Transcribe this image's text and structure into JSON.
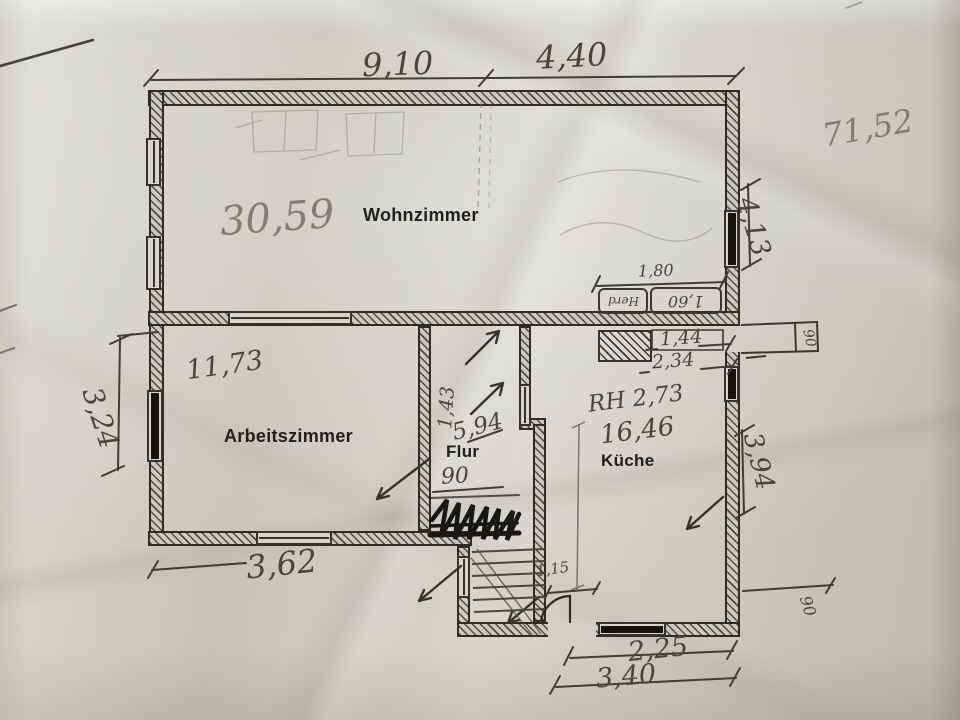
{
  "rooms": {
    "wohnzimmer": {
      "label": "Wohnzimmer",
      "area": "30,59"
    },
    "arbeitszimmer": {
      "label": "Arbeitszimmer",
      "area": "11,73"
    },
    "flur": {
      "label": "Flur",
      "area": "5,94",
      "door_width": "90"
    },
    "kueche": {
      "label": "Küche",
      "area": "16,46",
      "room_height": "RH 2,73"
    }
  },
  "dims": {
    "top_a": "9,10",
    "top_b": "4,40",
    "right_a": "4,13",
    "right_b": "3,94",
    "left_a": "3,24",
    "bottom_left": "3,62",
    "bottom_a": "2,25",
    "bottom_b": "3,40",
    "counter_top": "1,80",
    "counter_a": "1,44",
    "counter_b": "2,34",
    "entry_door": "1,15",
    "flur_width": "1,43",
    "door_right": "90",
    "door_bottom": "90",
    "total_area": "71,52"
  },
  "fixtures": {
    "stove": "Herd",
    "sink_len": "1,60"
  },
  "colors": {
    "paper": "#d2cfc7",
    "ink": "#21201b",
    "pencil": "#49453b"
  }
}
